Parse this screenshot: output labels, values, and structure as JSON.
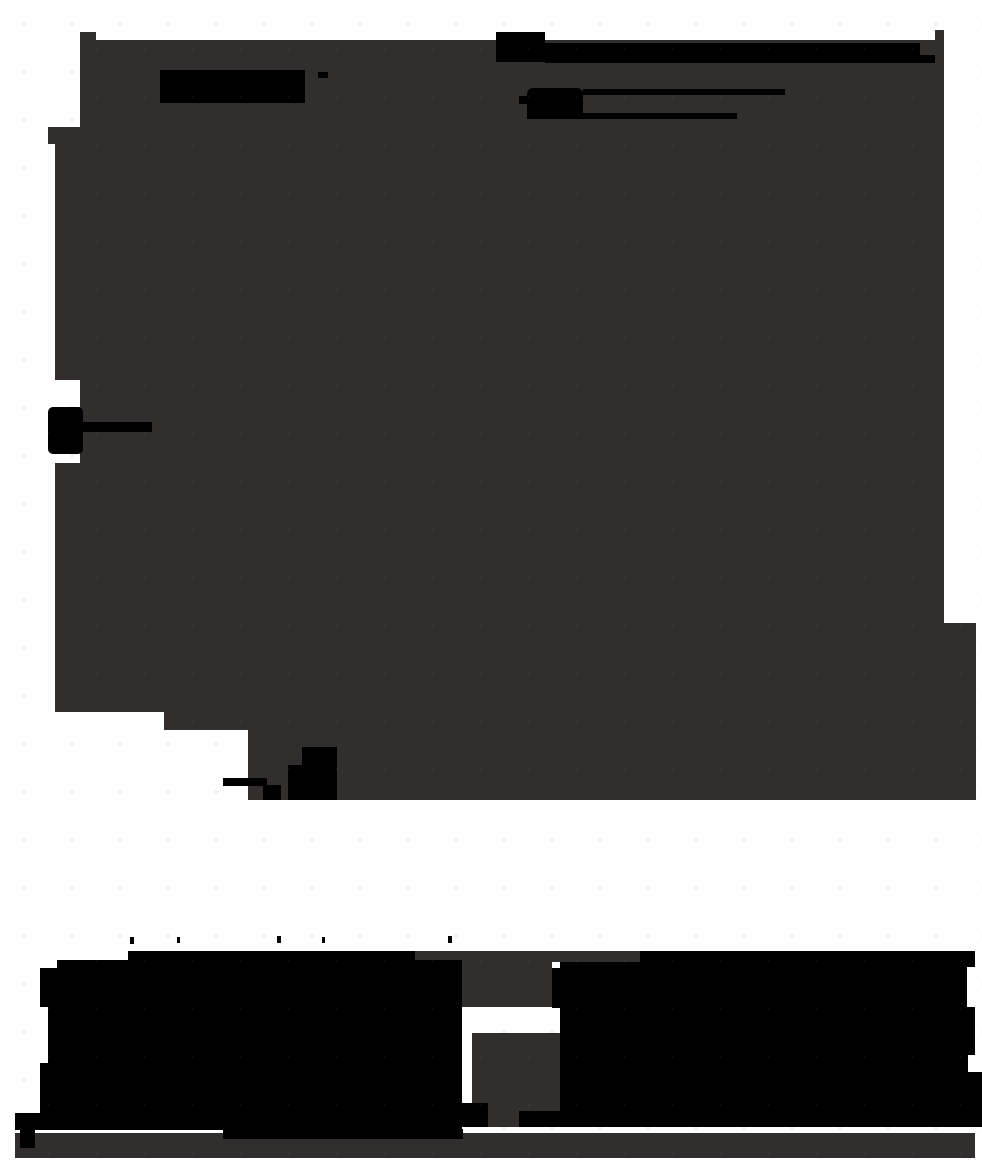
{
  "meta": {
    "canvas_width": 982,
    "canvas_height": 1167,
    "description": "Abstract glitched bitmap: dark translucent silhouette of a page/figure with opaque black redaction-style bars, legend marker with rule lines, axis-label blob with connector line, and large black masses at the bottom on a white background. No readable text is rendered in the pixels."
  },
  "colors": {
    "page_bg": "#ffffff",
    "silhouette": "#322e2d",
    "ink": "#000000"
  },
  "shapes": [
    {
      "name": "silhouette-upper-mass",
      "fill": "silhouette",
      "x": 55,
      "y": 127,
      "w": 889,
      "h": 603
    },
    {
      "name": "silhouette-top-band",
      "fill": "silhouette",
      "x": 80,
      "y": 40,
      "w": 864,
      "h": 87
    },
    {
      "name": "silhouette-corner-bump",
      "fill": "silhouette",
      "x": 80,
      "y": 32,
      "w": 16,
      "h": 9
    },
    {
      "name": "silhouette-left-step",
      "fill": "silhouette",
      "x": 48,
      "y": 127,
      "w": 7,
      "h": 17
    },
    {
      "name": "silhouette-right-column-top",
      "fill": "silhouette",
      "x": 935,
      "y": 30,
      "w": 9,
      "h": 12
    },
    {
      "name": "silhouette-lower-right-ext",
      "fill": "silhouette",
      "x": 944,
      "y": 623,
      "w": 32,
      "h": 107
    },
    {
      "name": "silhouette-lower-strip",
      "fill": "silhouette",
      "x": 248,
      "y": 730,
      "w": 728,
      "h": 70
    },
    {
      "name": "silhouette-gap-top-strip",
      "fill": "silhouette",
      "x": 415,
      "y": 951,
      "w": 225,
      "h": 11
    },
    {
      "name": "silhouette-gap-block-a",
      "fill": "silhouette",
      "x": 462,
      "y": 962,
      "w": 90,
      "h": 45
    },
    {
      "name": "silhouette-gap-block-b",
      "fill": "silhouette",
      "x": 472,
      "y": 1033,
      "w": 88,
      "h": 79
    },
    {
      "name": "silhouette-gap-block-c",
      "fill": "silhouette",
      "x": 472,
      "y": 1112,
      "w": 48,
      "h": 15
    },
    {
      "name": "silhouette-bottom-strip",
      "fill": "silhouette",
      "x": 15,
      "y": 1133,
      "w": 960,
      "h": 25
    },
    {
      "name": "cutout-left-pocket-upper",
      "fill": "page_bg",
      "x": 55,
      "y": 380,
      "w": 25,
      "h": 27
    },
    {
      "name": "cutout-left-pocket-lower",
      "fill": "page_bg",
      "x": 55,
      "y": 453,
      "w": 25,
      "h": 10
    },
    {
      "name": "cutout-bottom-left",
      "fill": "page_bg",
      "x": 48,
      "y": 712,
      "w": 116,
      "h": 18
    },
    {
      "name": "redacted-bar-1",
      "fill": "ink",
      "x": 160,
      "y": 70,
      "w": 145,
      "h": 33
    },
    {
      "name": "redacted-dash-1",
      "fill": "ink",
      "x": 318,
      "y": 72,
      "w": 10,
      "h": 6
    },
    {
      "name": "redacted-block-2",
      "fill": "ink",
      "x": 496,
      "y": 32,
      "w": 49,
      "h": 30
    },
    {
      "name": "redacted-bar-2",
      "fill": "ink",
      "x": 545,
      "y": 43,
      "w": 375,
      "h": 20
    },
    {
      "name": "redacted-bar-2-tail",
      "fill": "ink",
      "x": 920,
      "y": 55,
      "w": 15,
      "h": 8
    },
    {
      "name": "legend-cross-marker",
      "fill": "ink",
      "x": 519,
      "y": 96,
      "w": 14,
      "h": 8
    },
    {
      "name": "legend-blob",
      "fill": "ink",
      "x": 527,
      "y": 88,
      "w": 56,
      "h": 29,
      "r": 6
    },
    {
      "name": "legend-rule-line-1",
      "fill": "ink",
      "x": 583,
      "y": 89,
      "w": 202,
      "h": 6
    },
    {
      "name": "legend-rule-line-2",
      "fill": "ink",
      "x": 527,
      "y": 113,
      "w": 210,
      "h": 6
    },
    {
      "name": "axis-label-blob",
      "fill": "ink",
      "x": 48,
      "y": 407,
      "w": 35,
      "h": 47,
      "r": 5
    },
    {
      "name": "axis-label-connector-line",
      "fill": "ink",
      "x": 83,
      "y": 422,
      "w": 69,
      "h": 10
    },
    {
      "name": "bottom-label-dash",
      "fill": "ink",
      "x": 223,
      "y": 778,
      "w": 44,
      "h": 8
    },
    {
      "name": "bottom-label-bits",
      "fill": "ink",
      "x": 263,
      "y": 785,
      "w": 18,
      "h": 15
    },
    {
      "name": "bottom-label-blob-top",
      "fill": "ink",
      "x": 302,
      "y": 747,
      "w": 35,
      "h": 20
    },
    {
      "name": "bottom-label-blob",
      "fill": "ink",
      "x": 288,
      "y": 765,
      "w": 49,
      "h": 35
    },
    {
      "name": "tick-artifact-1",
      "fill": "ink",
      "x": 130,
      "y": 937,
      "w": 4,
      "h": 7
    },
    {
      "name": "tick-artifact-2",
      "fill": "ink",
      "x": 177,
      "y": 937,
      "w": 3,
      "h": 6
    },
    {
      "name": "tick-artifact-3",
      "fill": "ink",
      "x": 277,
      "y": 936,
      "w": 4,
      "h": 7
    },
    {
      "name": "tick-artifact-4",
      "fill": "ink",
      "x": 322,
      "y": 937,
      "w": 3,
      "h": 6
    },
    {
      "name": "tick-artifact-5",
      "fill": "ink",
      "x": 448,
      "y": 936,
      "w": 4,
      "h": 7
    },
    {
      "name": "black-mass-left-top-bump",
      "fill": "ink",
      "x": 128,
      "y": 951,
      "w": 287,
      "h": 9
    },
    {
      "name": "black-mass-left-step",
      "fill": "ink",
      "x": 57,
      "y": 960,
      "w": 405,
      "h": 8
    },
    {
      "name": "black-mass-left",
      "fill": "ink",
      "x": 40,
      "y": 968,
      "w": 422,
      "h": 162
    },
    {
      "name": "black-mass-left-foot",
      "fill": "ink",
      "x": 15,
      "y": 1113,
      "w": 25,
      "h": 17
    },
    {
      "name": "black-mass-foot-bit",
      "fill": "ink",
      "x": 20,
      "y": 1130,
      "w": 15,
      "h": 18
    },
    {
      "name": "black-mass-left-bottom-step",
      "fill": "ink",
      "x": 223,
      "y": 1129,
      "w": 240,
      "h": 10
    },
    {
      "name": "gap-glyph-marks",
      "fill": "ink",
      "x": 462,
      "y": 1103,
      "w": 26,
      "h": 24
    },
    {
      "name": "gap-bottom-bits",
      "fill": "ink",
      "x": 519,
      "y": 1111,
      "w": 49,
      "h": 16
    },
    {
      "name": "black-mass-right-step",
      "fill": "ink",
      "x": 552,
      "y": 968,
      "w": 8,
      "h": 40
    },
    {
      "name": "black-mass-right",
      "fill": "ink",
      "x": 560,
      "y": 962,
      "w": 415,
      "h": 165
    },
    {
      "name": "black-mass-right-top-bump",
      "fill": "ink",
      "x": 640,
      "y": 951,
      "w": 335,
      "h": 11
    },
    {
      "name": "black-mass-right-edge-sliver",
      "fill": "ink",
      "x": 975,
      "y": 1072,
      "w": 7,
      "h": 55
    },
    {
      "name": "cutout-left-mass-pocket",
      "fill": "page_bg",
      "x": 40,
      "y": 1007,
      "w": 8,
      "h": 56
    },
    {
      "name": "cutout-right-mass-notch-a",
      "fill": "page_bg",
      "x": 967,
      "y": 967,
      "w": 15,
      "h": 40
    },
    {
      "name": "cutout-right-mass-notch-b",
      "fill": "page_bg",
      "x": 968,
      "y": 1055,
      "w": 14,
      "h": 17
    }
  ]
}
